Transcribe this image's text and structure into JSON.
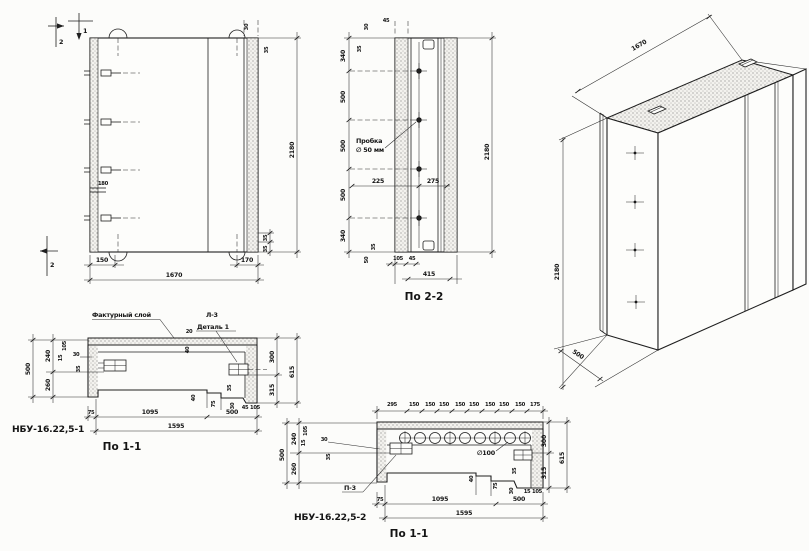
{
  "front": {
    "marker_top_v": "2",
    "marker_top_h": "1",
    "marker_bottom": "2",
    "dim_bottom_left": "150",
    "dim_bottom_right": "170",
    "dim_width": "1670",
    "dim_height": "2180",
    "dim_top_small_a": "30",
    "dim_top_small_b": "35",
    "dim_right_small_a": "35",
    "dim_right_small_b": "35",
    "dim_anchor": "180"
  },
  "sec22": {
    "title": "По 2-2",
    "left_chain": [
      "340",
      "500",
      "500",
      "500",
      "340"
    ],
    "plug_note_1": "Пробка",
    "plug_note_2": "∅ 50 мм",
    "dim_225": "225",
    "dim_275": "275",
    "dim_height": "2180",
    "dim_top_a": "30",
    "dim_top_b": "35",
    "dim_top_c": "45",
    "dim_bot_35": "35",
    "dim_bot_50": "50",
    "dim_bot_105": "105",
    "dim_bot_45": "45",
    "dim_width": "415"
  },
  "iso": {
    "dim_width": "1670",
    "dim_height": "2180",
    "dim_depth": "500"
  },
  "sec11a": {
    "part": "НБУ-16.22,5-1",
    "title": "По 1-1",
    "note_layer": "Фактурный слой",
    "note_l3": "Л-3",
    "note_detail": "Деталь 1",
    "dim_20": "20",
    "dim_40": "40",
    "left_total": "500",
    "left_top": "240",
    "left_bottom": "260",
    "small_105": "105",
    "small_15": "15",
    "small_30": "30",
    "small_35": "35",
    "right_top": "300",
    "right_bottom": "315",
    "right_total": "615",
    "in_40": "40",
    "in_35": "35",
    "in_75": "75",
    "in_30": "30",
    "in_45": "45",
    "in_105": "105",
    "bot_75": "75",
    "bot_1095": "1095",
    "bot_500": "500",
    "bot_total": "1595"
  },
  "sec11b": {
    "part": "НБУ-16.22,5-2",
    "title": "По 1-1",
    "top_chain": [
      "295",
      "150",
      "150",
      "150",
      "150",
      "150",
      "150",
      "150",
      "150",
      "175"
    ],
    "note_hole": "∅100",
    "note_p3": "П-3",
    "left_total": "500",
    "left_top": "240",
    "left_bottom": "260",
    "small_105": "105",
    "small_15": "15",
    "small_30": "30",
    "small_35": "35",
    "right_top": "300",
    "right_bottom": "315",
    "right_total": "615",
    "in_40": "40",
    "in_75": "75",
    "in_35": "35",
    "in_30": "30",
    "in_15": "15",
    "in_105": "105",
    "bot_75": "75",
    "bot_1095": "1095",
    "bot_500": "500",
    "bot_total": "1595"
  }
}
